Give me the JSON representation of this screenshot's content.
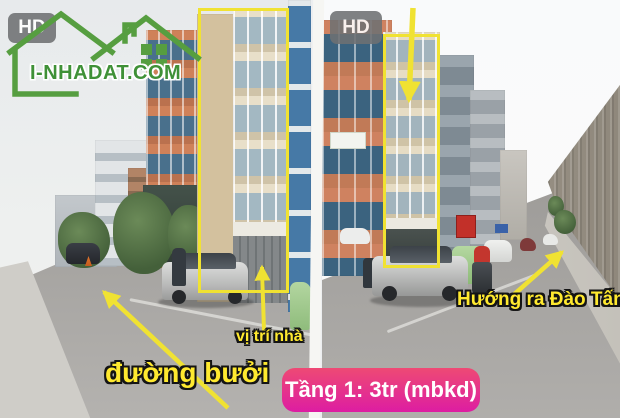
{
  "brand": {
    "logo_text": "I-NHADAT.COM"
  },
  "badges": {
    "hd_left": "HD",
    "hd_right": "HD"
  },
  "annotations": {
    "street_name": "đường bưởi",
    "house_position": "vị trí nhà",
    "direction": "Hướng ra Đào Tấn",
    "price_badge": "Tầng 1: 3tr (mbkd)"
  },
  "colors": {
    "annotation_yellow": "#f0e232",
    "label_yellow": "#ffe92f",
    "logo_green": "#3f9137",
    "badge_pink_top": "#ee4a74",
    "badge_pink_bottom": "#dd1da2",
    "hd_badge_bg": "#6f7173"
  }
}
